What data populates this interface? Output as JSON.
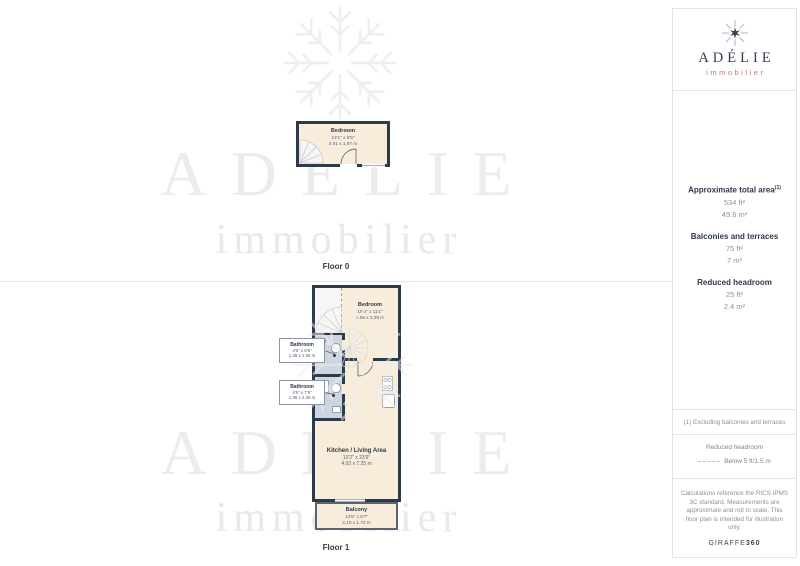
{
  "logo": {
    "name": "ADÉLIE",
    "tagline": "immobilier"
  },
  "watermark": {
    "name": "ADÉLIE",
    "tagline": "immobilier"
  },
  "floors": {
    "floor0_label": "Floor 0",
    "floor1_label": "Floor 1"
  },
  "floor0": {
    "bedroom": {
      "name": "Bedroom",
      "imperial": "13'1\" x 6'5\"",
      "metric": "4.01 x 1.97 m"
    }
  },
  "floor1": {
    "bedroom": {
      "name": "Bedroom",
      "imperial": "10'0\" x 11'1\"",
      "metric": "3.06 x 3.39 m"
    },
    "bathroom1": {
      "name": "Bathroom",
      "imperial": "4'6\" x 6'6\"",
      "metric": "1.38 x 1.98 m"
    },
    "bathroom2": {
      "name": "Bathroom",
      "imperial": "4'6\" x 7'9\"",
      "metric": "1.38 x 2.36 m"
    },
    "kitchen_living": {
      "name": "Kitchen / Living Area",
      "imperial": "13'2\" x 23'9\"",
      "metric": "4.03 x 7.25 m"
    },
    "balcony": {
      "name": "Balcony",
      "imperial": "13'5\" x 5'7\"",
      "metric": "4.10 x 1.72 m"
    }
  },
  "info_panel": {
    "total_area_label": "Approximate total area",
    "total_area_sup": "(1)",
    "total_area_imperial": "534 ft²",
    "total_area_metric": "49.6 m²",
    "balconies_label": "Balconies and terraces",
    "balconies_imperial": "75 ft²",
    "balconies_metric": "7 m²",
    "headroom_label": "Reduced headroom",
    "headroom_imperial": "25 ft²",
    "headroom_metric": "2.4 m²",
    "footnote": "(1) Excluding balconies and terraces",
    "legend_title": "Reduced headroom",
    "legend_item": "Below 5 ft/1.5 m",
    "disclaimer": "Calculations reference the RICS IPMS 3C standard. Measurements are approximate and not to scale. This floor plan is intended for illustration only.",
    "brand_name": "GIRAFFE",
    "brand_suffix": "360"
  },
  "colors": {
    "wall": "#2c3a49",
    "room_fill": "#f8edda",
    "bathroom_fill": "#cdd5e2",
    "balcony_outline": "#5a6472",
    "logo_navy": "#323e50",
    "logo_salmon": "#c07a6e",
    "watermark_gray": "#ececec",
    "panel_border": "#e3e3e3",
    "text_gray": "#8b919b",
    "text_dark": "#2f3a48"
  }
}
